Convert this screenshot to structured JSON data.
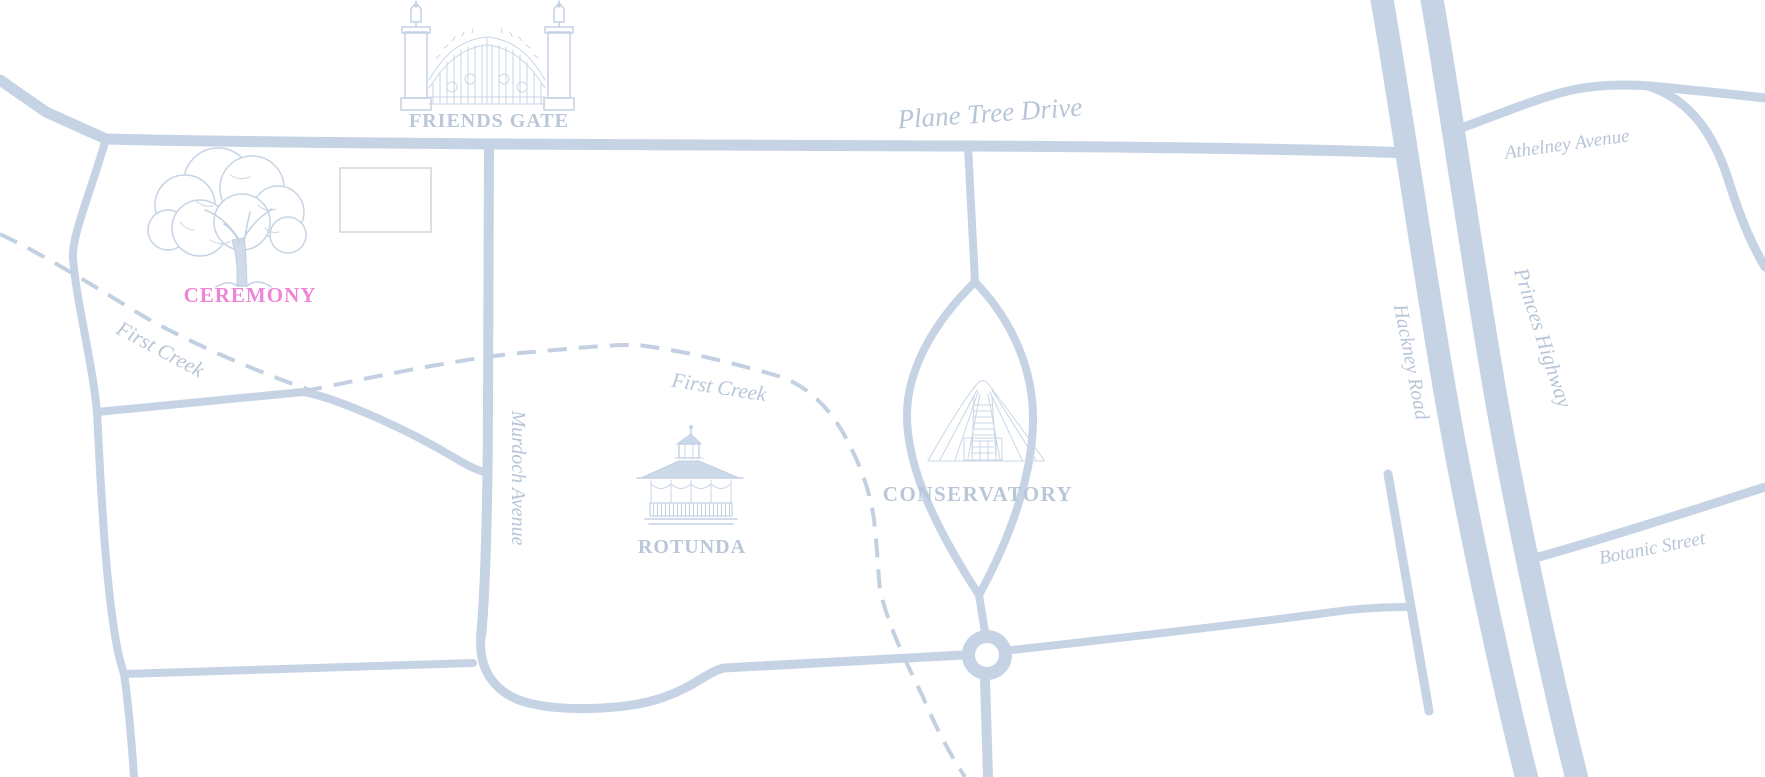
{
  "map": {
    "streets": {
      "plane_tree_drive": "Plane Tree Drive",
      "athelney_avenue": "Athelney Avenue",
      "murdoch_avenue": "Murdoch Avenue",
      "hackney_road": "Hackney Road",
      "princes_highway": "Princes Highway",
      "botanic_street": "Botanic Street"
    },
    "waterways": {
      "first_creek_upper": "First Creek",
      "first_creek_lower": "First Creek"
    },
    "places": {
      "friends_gate": "FRIENDS GATE",
      "rotunda": "ROTUNDA",
      "conservatory": "CONSERVATORY"
    },
    "markers": {
      "ceremony": "CEREMONY"
    },
    "colors": {
      "background": "#ffffff",
      "road": "#c5d3e4",
      "street_label": "#b7c5d7",
      "place_label": "#b9c7d9",
      "ceremony_pink": "#ee86d7",
      "illustration": "#c3d1e3",
      "creek": "#c2d0e1",
      "callout_border": "#cfd5dc"
    }
  }
}
